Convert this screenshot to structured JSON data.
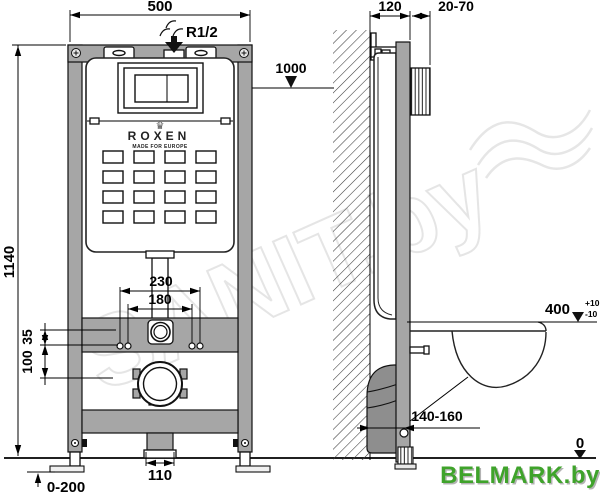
{
  "watermark": {
    "text": "SANIT.by"
  },
  "vendor_logo": {
    "text": "BELMARK.by",
    "color": "#3fa32b"
  },
  "product_label": {
    "crown_icon": "♛",
    "brand": "ROXEN",
    "tagline": "MADE FOR EUROPE"
  },
  "front_view": {
    "width_mm": "500",
    "height_mm": "1140",
    "water_inlet": "R1/2",
    "button_height_mm": "1000",
    "stud_spacing_outer": "230",
    "stud_spacing_inner": "180",
    "offset_small": "35",
    "offset_large": "100",
    "outlet_width": "110",
    "feet_adjust_range": "0-200"
  },
  "side_view": {
    "frame_depth": "120",
    "plate_depth_range": "20-70",
    "seat_height": "400",
    "seat_tol_plus": "+10",
    "seat_tol_minus": "-10",
    "outlet_distance_range": "140-160",
    "floor_level": "0"
  },
  "colors": {
    "frame_gray": "#a6a6a6",
    "pipe_gray": "#8e8e8e",
    "logo_green": "#3fa32b",
    "watermark_gray": "#e3e3e3"
  }
}
